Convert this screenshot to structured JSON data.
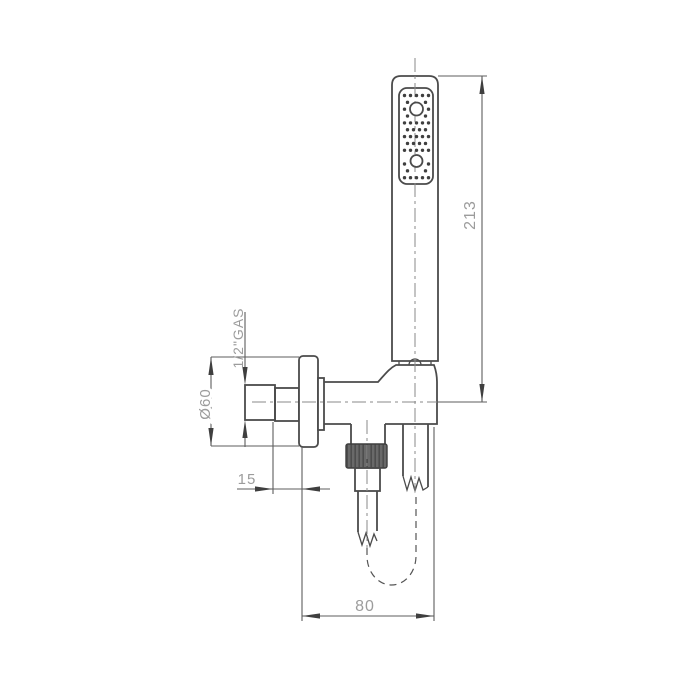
{
  "drawing": {
    "kind": "technical-dimension-drawing",
    "subject": "wall-mounted hand shower set with water outlet holder and flexible hose",
    "background_color": "#ffffff",
    "line_color": "#4b4b4b",
    "dimension_line_color": "#5e5e5e",
    "text_color": "#9c9c9c",
    "knurl_fill_color": "#666666",
    "dimensions": {
      "overall_height": {
        "label": "213",
        "value": 213
      },
      "plate_diameter": {
        "label": "Ø60",
        "value": 60
      },
      "thread": {
        "label": "1/2\"GAS"
      },
      "plate_offset": {
        "label": "15",
        "value": 15
      },
      "body_depth": {
        "label": "80",
        "value": 80
      }
    }
  }
}
